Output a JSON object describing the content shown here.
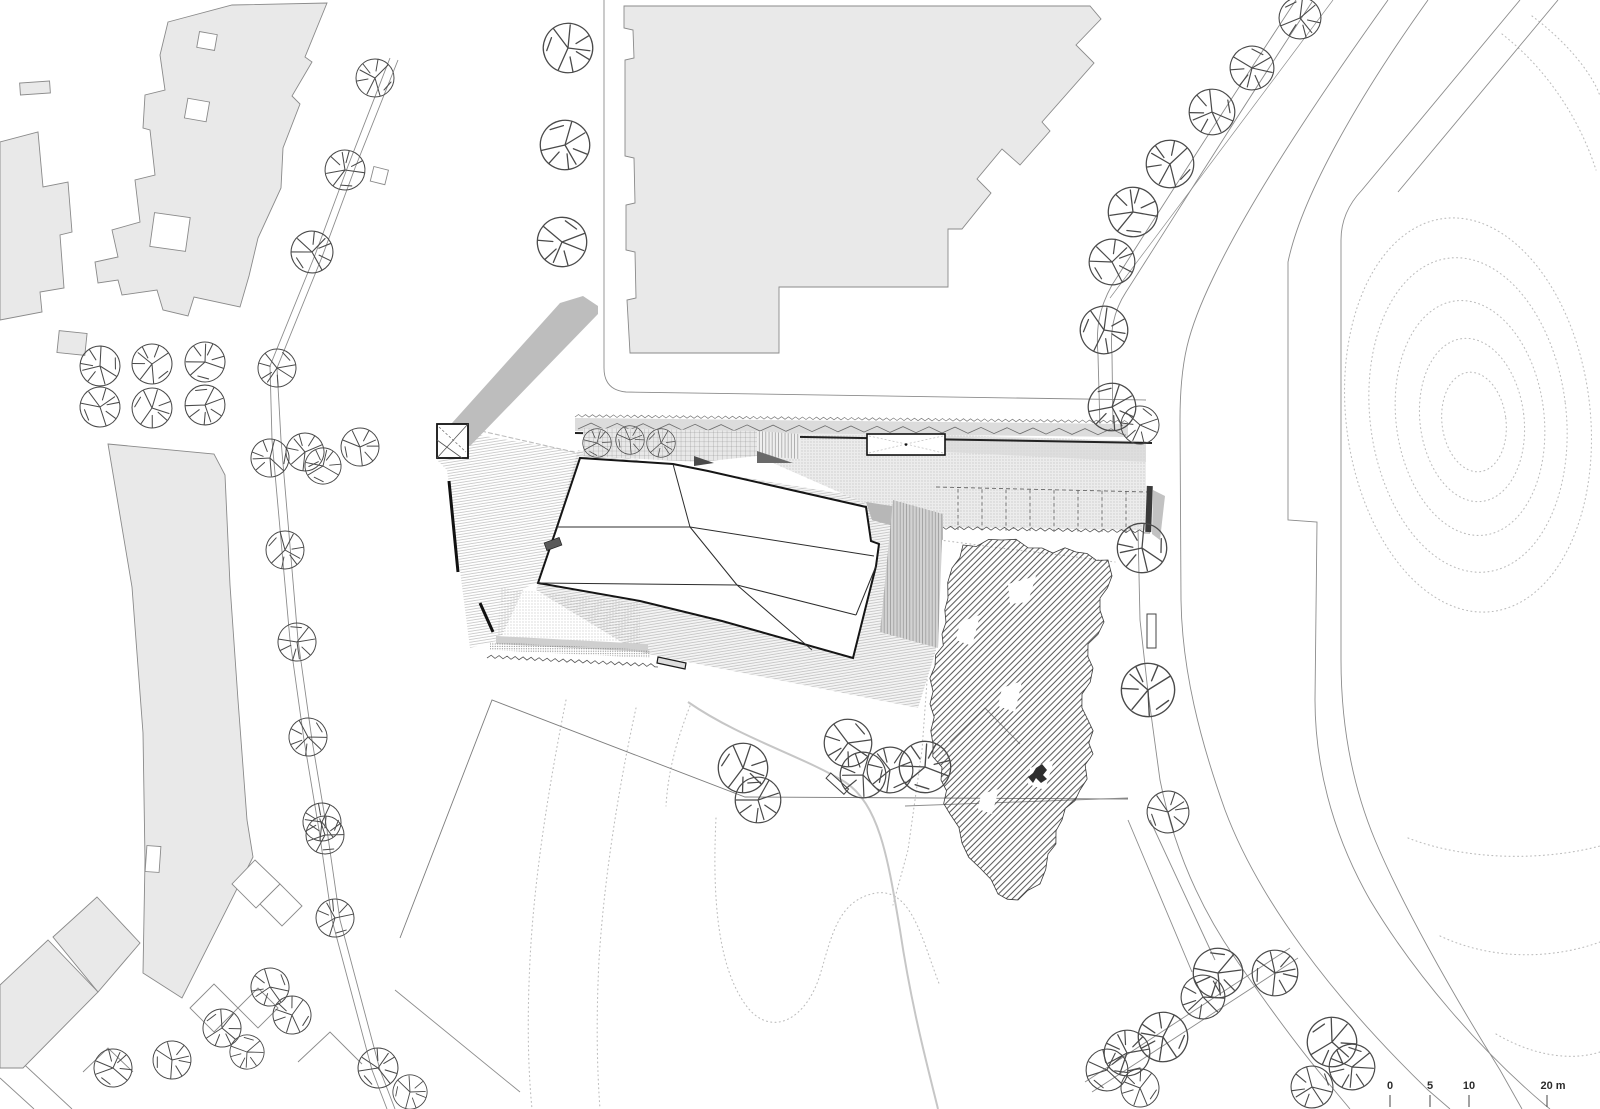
{
  "document": {
    "type": "architectural-site-plan",
    "description": "Black and white site plan drawing with existing grey context buildings, a central folded-roof building with hatched plaza, parking strip, wild garden, tree-lined streets and dotted terrain contours"
  },
  "colors": {
    "paper": "#ffffff",
    "context_building_fill": "#e9e9e9",
    "context_building_stroke": "#8a8a8a",
    "main_ink": "#151515",
    "shadow_grey": "#b9b9b9",
    "hedge_grey": "#dcdcdc",
    "road_line": "#8c8c8c",
    "contour_dotted": "#bdbdbd"
  },
  "scale_bar": {
    "unit_labels": [
      {
        "text": "0",
        "x": 1390,
        "tick_x": 1390
      },
      {
        "text": "5",
        "x": 1430,
        "tick_x": 1430
      },
      {
        "text": "10",
        "x": 1469,
        "tick_x": 1469
      },
      {
        "text": "20 m",
        "x": 1553,
        "tick_x": 1547
      }
    ],
    "label_y": 1089,
    "tick_y1": 1095,
    "tick_y2": 1107
  },
  "plan": {
    "trees": [
      [
        375,
        78,
        20
      ],
      [
        345,
        170,
        21
      ],
      [
        312,
        252,
        22
      ],
      [
        568,
        48,
        26
      ],
      [
        565,
        145,
        26
      ],
      [
        562,
        242,
        26
      ],
      [
        100,
        366,
        21
      ],
      [
        152,
        364,
        21
      ],
      [
        205,
        362,
        21
      ],
      [
        100,
        407,
        21
      ],
      [
        152,
        408,
        21
      ],
      [
        205,
        405,
        21
      ],
      [
        277,
        368,
        20
      ],
      [
        270,
        458,
        20
      ],
      [
        305,
        452,
        20
      ],
      [
        323,
        466,
        19
      ],
      [
        360,
        447,
        20
      ],
      [
        285,
        550,
        20
      ],
      [
        297,
        642,
        20
      ],
      [
        308,
        737,
        20
      ],
      [
        322,
        822,
        20
      ],
      [
        335,
        918,
        20
      ],
      [
        113,
        1068,
        20
      ],
      [
        172,
        1060,
        20
      ],
      [
        222,
        1028,
        20
      ],
      [
        247,
        1052,
        18
      ],
      [
        270,
        987,
        20
      ],
      [
        292,
        1015,
        20
      ],
      [
        325,
        835,
        20
      ],
      [
        378,
        1068,
        21
      ],
      [
        410,
        1092,
        18
      ],
      [
        1300,
        18,
        22
      ],
      [
        1252,
        68,
        23
      ],
      [
        1212,
        112,
        24
      ],
      [
        1170,
        164,
        25
      ],
      [
        1133,
        212,
        26
      ],
      [
        1112,
        262,
        24
      ],
      [
        1104,
        330,
        25
      ],
      [
        1112,
        407,
        25
      ],
      [
        1140,
        425,
        20
      ],
      [
        1142,
        548,
        26
      ],
      [
        1148,
        690,
        28
      ],
      [
        925,
        767,
        27
      ],
      [
        1168,
        812,
        22
      ],
      [
        743,
        768,
        26
      ],
      [
        758,
        800,
        24
      ],
      [
        848,
        743,
        25
      ],
      [
        863,
        775,
        24
      ],
      [
        890,
        770,
        24
      ],
      [
        597,
        443,
        15
      ],
      [
        630,
        440,
        15
      ],
      [
        661,
        443,
        15
      ],
      [
        1218,
        973,
        26
      ],
      [
        1203,
        997,
        23
      ],
      [
        1163,
        1037,
        26
      ],
      [
        1127,
        1053,
        24
      ],
      [
        1107,
        1070,
        22
      ],
      [
        1275,
        973,
        24
      ],
      [
        1332,
        1042,
        26
      ],
      [
        1352,
        1067,
        24
      ],
      [
        1312,
        1087,
        22
      ],
      [
        1140,
        1088,
        20
      ]
    ],
    "parking": {
      "stall_first_x": 958,
      "stall_step": 24,
      "stall_count": 9,
      "top_y": 489,
      "height": 41
    }
  }
}
